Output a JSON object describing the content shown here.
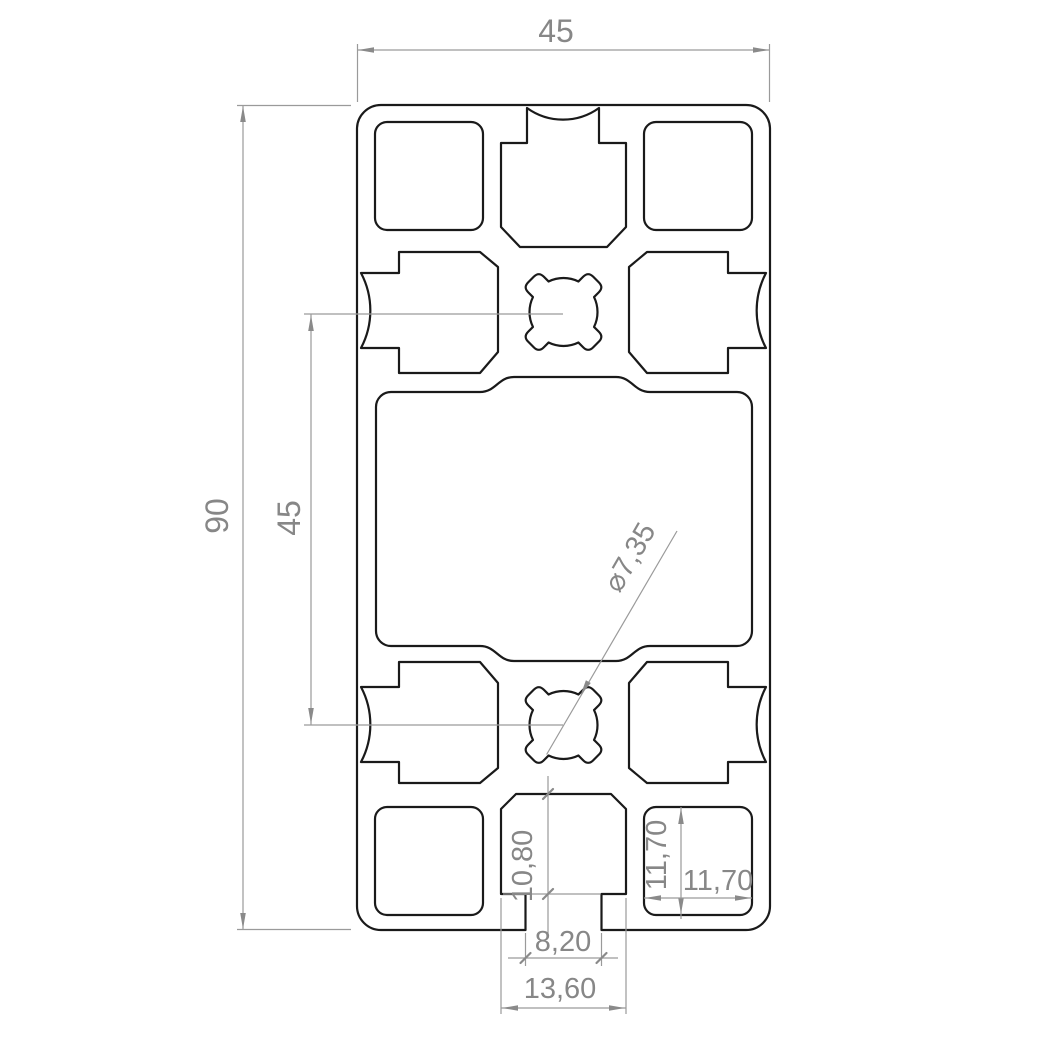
{
  "drawing": {
    "dimensions": {
      "width_top": {
        "value": "45"
      },
      "height_left": {
        "value": "90"
      },
      "port_spacing": {
        "value": "45"
      },
      "core_hole_diameter": {
        "value": "⌀7,35"
      },
      "slot_cavity_height": {
        "value": "10,80"
      },
      "square_cavity_height": {
        "value": "11,70"
      },
      "square_cavity_width": {
        "value": "11,70"
      },
      "slot_opening_width": {
        "value": "8,20"
      },
      "slot_cavity_width": {
        "value": "13,60"
      }
    },
    "colors": {
      "profile_line": "#1a1a1a",
      "dimension_line": "#9a9a9a",
      "dimension_text": "#878787",
      "background": "#ffffff"
    }
  }
}
